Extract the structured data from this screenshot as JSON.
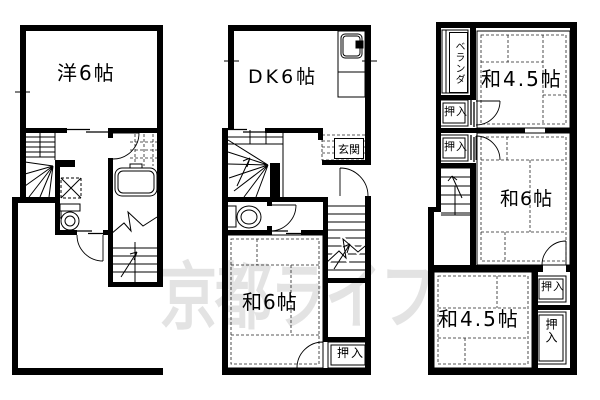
{
  "watermark": {
    "text": "京都ライフ",
    "color": "#e3e3e3"
  },
  "colors": {
    "background": "#ffffff",
    "line": "#000000",
    "watermark": "#e3e3e3"
  },
  "floor1": {
    "western_room": "洋6帖"
  },
  "floor2": {
    "dining_kitchen": "DK6帖",
    "entrance": "玄関",
    "tatami_room": "和6帖",
    "closet": "押入"
  },
  "floor3": {
    "veranda": "ベランダ",
    "tatami_top": "和4.5帖",
    "closet_left_top": "押入",
    "closet_left_mid": "押入",
    "tatami_mid": "和6帖",
    "tatami_bottom": "和4.5帖",
    "closet_right_top": "押入",
    "closet_right_bottom": "押入"
  }
}
